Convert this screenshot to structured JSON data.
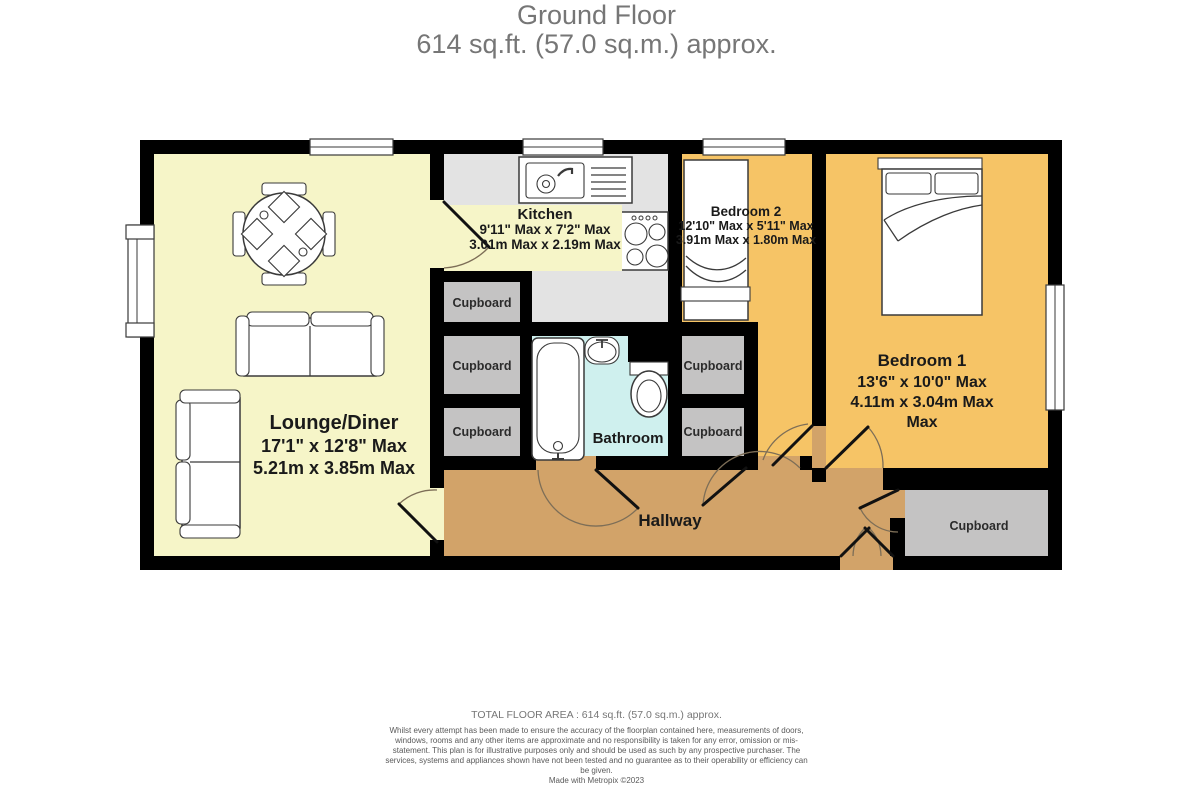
{
  "title": {
    "line1": "Ground Floor",
    "line2": "614 sq.ft. (57.0 sq.m.) approx."
  },
  "rooms": {
    "lounge": {
      "name": "Lounge/Diner",
      "imperial": "17'1\"  x 12'8\" Max",
      "metric": "5.21m  x 3.85m Max"
    },
    "kitchen": {
      "name": "Kitchen",
      "imperial": "9'11\" Max x 7'2\" Max",
      "metric": "3.01m Max x 2.19m Max"
    },
    "bedroom2": {
      "name": "Bedroom 2",
      "imperial": "12'10\" Max x 5'11\" Max",
      "metric": "3.91m Max x 1.80m Max"
    },
    "bedroom1": {
      "name": "Bedroom 1",
      "imperial": "13'6\"  x 10'0\" Max",
      "metric": "4.11m  x 3.04m Max",
      "metric_overflow": "Max"
    },
    "bathroom": {
      "name": "Bathroom"
    },
    "hallway": {
      "name": "Hallway"
    }
  },
  "labels": {
    "cupboard": "Cupboard"
  },
  "footer": {
    "total": "TOTAL FLOOR AREA : 614 sq.ft. (57.0 sq.m.) approx.",
    "disclaimer": "Whilst every attempt has been made to ensure the accuracy of the floorplan contained here, measurements of doors, windows, rooms and any other items are approximate and no responsibility is taken for any error, omission or mis-statement. This plan is for illustrative purposes only and should be used as such by any prospective purchaser. The services, systems and appliances shown have not been tested and no guarantee as to their operability or efficiency can be given.",
    "credit": "Made with Metropix ©2023"
  },
  "colors": {
    "wall": "#000000",
    "lounge_floor": "#f6f5c8",
    "kitchen_floor": "#e3e3e3",
    "bedroom_floor": "#f6c466",
    "bathroom_floor": "#cff0ee",
    "hallway_floor": "#d2a369",
    "cupboard_floor": "#c4c3c3",
    "title_text": "#767676"
  }
}
